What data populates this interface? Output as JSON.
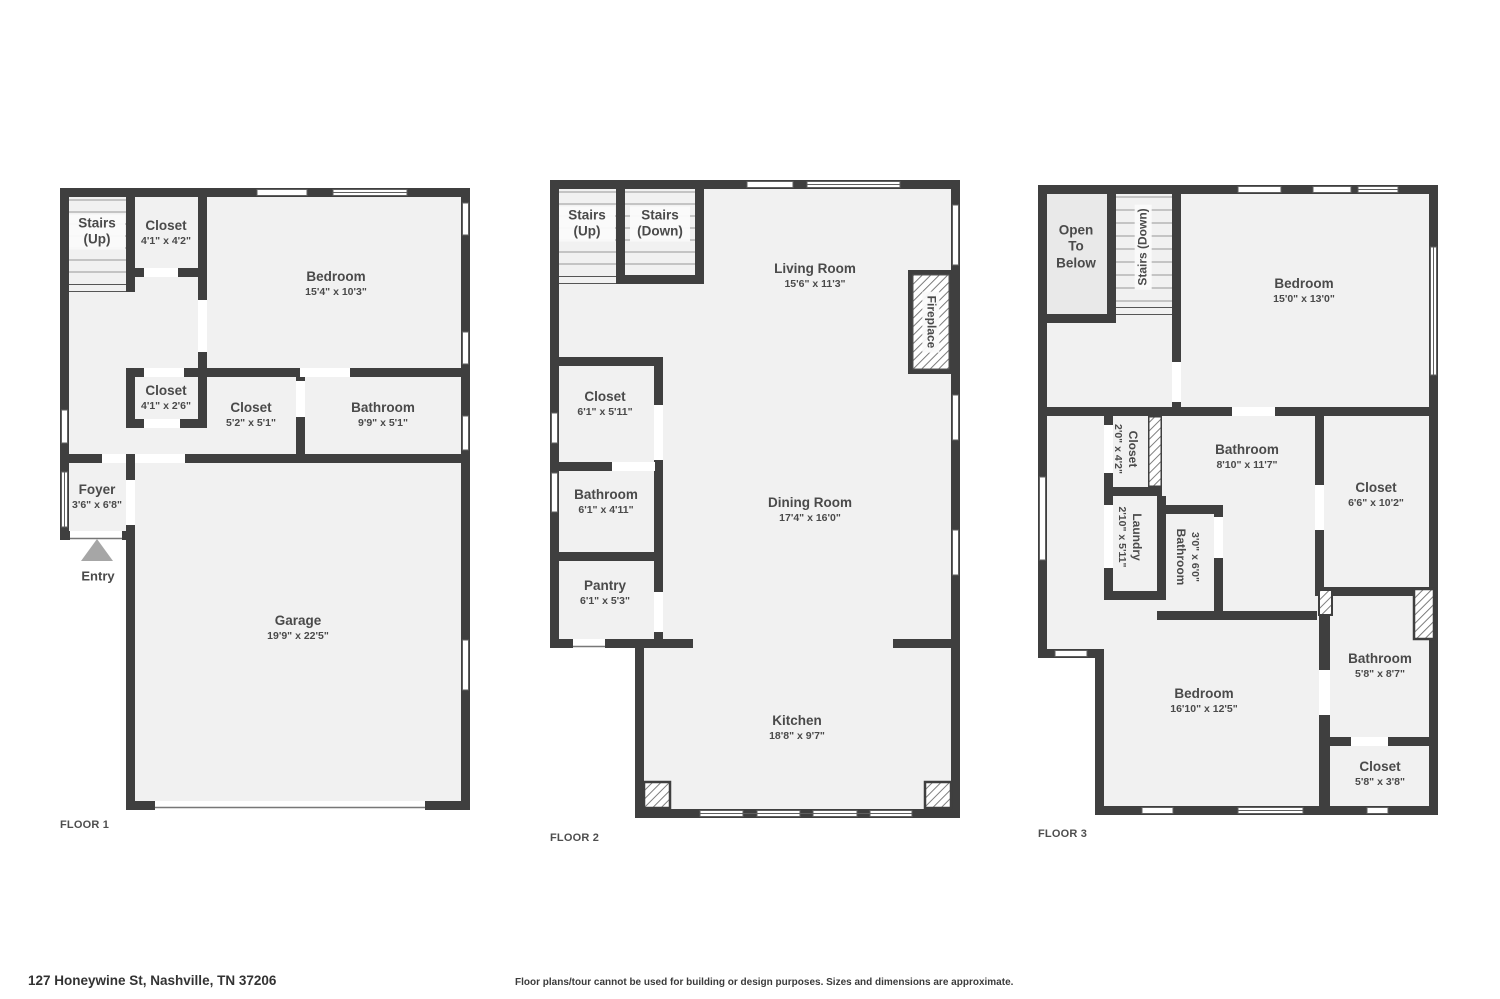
{
  "meta": {
    "address": "127 Honeywine St, Nashville, TN 37206",
    "disclaimer": "Floor plans/tour cannot be used for building or design purposes. Sizes and dimensions are approximate."
  },
  "colors": {
    "wall": "#3f3f3f",
    "floor_fill": "#f1f1f1",
    "open_to_below_fill": "#e9e9e9"
  },
  "floors": [
    {
      "label": "FLOOR 1",
      "entry_label": "Entry",
      "rooms": [
        {
          "name": "Stairs (Up)",
          "dims": ""
        },
        {
          "name": "Closet",
          "dims": "4'1\" x 4'2\""
        },
        {
          "name": "Bedroom",
          "dims": "15'4\" x 10'3\""
        },
        {
          "name": "Closet",
          "dims": "4'1\" x 2'6\""
        },
        {
          "name": "Closet",
          "dims": "5'2\" x 5'1\""
        },
        {
          "name": "Bathroom",
          "dims": "9'9\" x 5'1\""
        },
        {
          "name": "Foyer",
          "dims": "3'6\" x 6'8\""
        },
        {
          "name": "Garage",
          "dims": "19'9\" x 22'5\""
        }
      ]
    },
    {
      "label": "FLOOR 2",
      "rooms": [
        {
          "name": "Stairs (Up)",
          "dims": ""
        },
        {
          "name": "Stairs (Down)",
          "dims": ""
        },
        {
          "name": "Living Room",
          "dims": "15'6\" x 11'3\""
        },
        {
          "name": "Fireplace",
          "dims": ""
        },
        {
          "name": "Closet",
          "dims": "6'1\" x 5'11\""
        },
        {
          "name": "Dining Room",
          "dims": "17'4\" x 16'0\""
        },
        {
          "name": "Bathroom",
          "dims": "6'1\" x 4'11\""
        },
        {
          "name": "Pantry",
          "dims": "6'1\" x 5'3\""
        },
        {
          "name": "Kitchen",
          "dims": "18'8\" x 9'7\""
        }
      ]
    },
    {
      "label": "FLOOR 3",
      "rooms": [
        {
          "name": "Open To Below",
          "dims": ""
        },
        {
          "name": "Stairs (Down)",
          "dims": ""
        },
        {
          "name": "Bedroom",
          "dims": "15'0\" x 13'0\""
        },
        {
          "name": "Closet",
          "dims": "2'0\" x 4'2\""
        },
        {
          "name": "Bathroom",
          "dims": "8'10\" x 11'7\""
        },
        {
          "name": "Closet",
          "dims": "6'6\" x 10'2\""
        },
        {
          "name": "Laundry",
          "dims": "2'10\" x 5'11\""
        },
        {
          "name": "Bathroom",
          "dims": "3'0\" x 6'0\""
        },
        {
          "name": "Bedroom",
          "dims": "16'10\" x 12'5\""
        },
        {
          "name": "Bathroom",
          "dims": "5'8\" x 8'7\""
        },
        {
          "name": "Closet",
          "dims": "5'8\" x 3'8\""
        }
      ]
    }
  ]
}
